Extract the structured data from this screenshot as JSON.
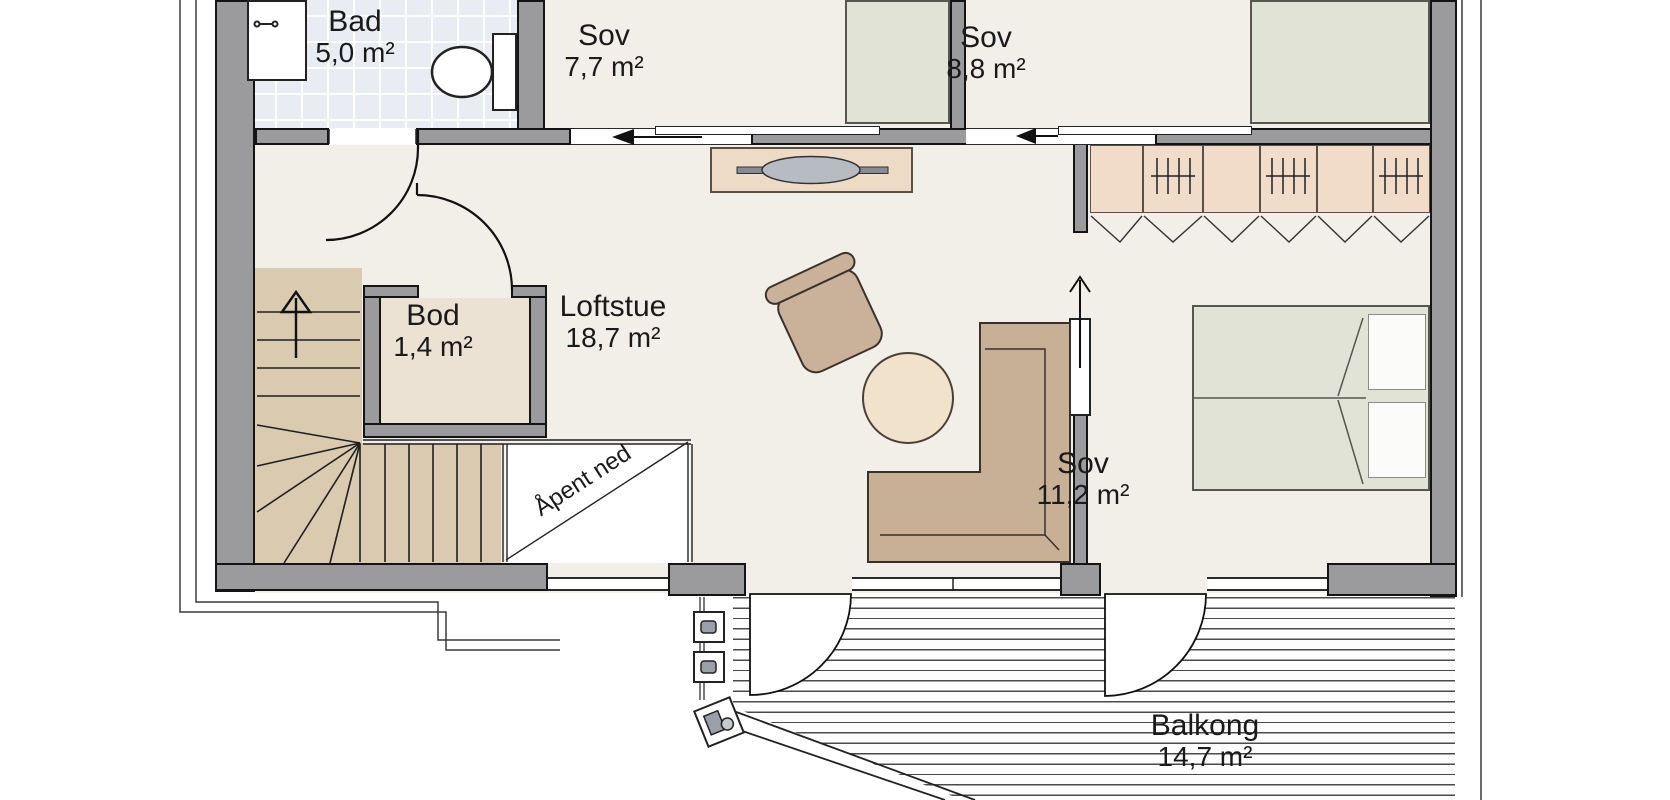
{
  "rooms": [
    {
      "id": "bad",
      "name": "Bad",
      "area": "5,0 m²"
    },
    {
      "id": "sov-77",
      "name": "Sov",
      "area": "7,7 m²"
    },
    {
      "id": "sov-88",
      "name": "Sov",
      "area": "8,8 m²"
    },
    {
      "id": "bod",
      "name": "Bod",
      "area": "1,4 m²"
    },
    {
      "id": "loftstue",
      "name": "Loftstue",
      "area": "18,7 m²"
    },
    {
      "id": "sov-112",
      "name": "Sov",
      "area": "11,2 m²"
    },
    {
      "id": "balkong",
      "name": "Balkong",
      "area": "14,7 m²"
    }
  ],
  "annotations": {
    "open_below": "Åpent ned"
  },
  "colors": {
    "wall": "#9b9b9d",
    "wall_outline": "#141414",
    "floor": "#f2efe8",
    "bod_floor": "#ebe2d3",
    "tile": "#e9ecf3",
    "stairs": "#dacaaf",
    "furniture_tan": "#eedbc6",
    "wardrobe": "#f0dcc8",
    "sofa": "#c8b096",
    "armchair": "#cab29a",
    "pouf": "#f0e2cb",
    "bed": "#e0e3d6",
    "metal": "#9aa0a8"
  }
}
